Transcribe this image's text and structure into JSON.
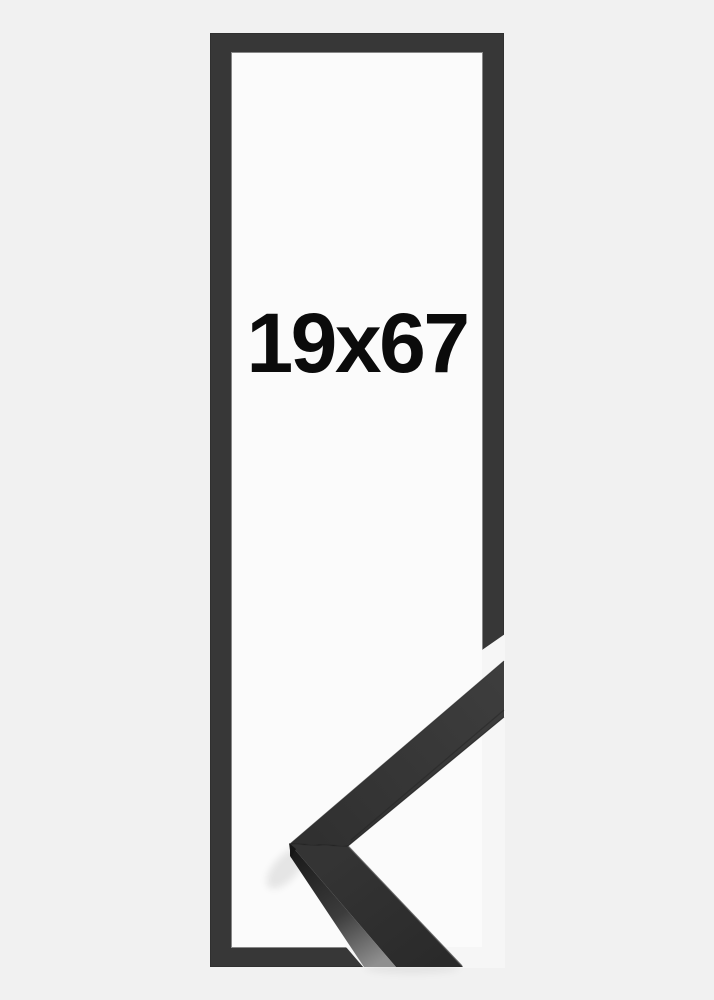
{
  "product": {
    "size_label": "19x67"
  },
  "images": {
    "corner_sample": "black-frame-mitred-corner-closeup"
  },
  "colors": {
    "background": "#f1f1f1",
    "aperture": "#fbfbfb",
    "frame": "#373737",
    "gap": "#f6f6f6",
    "label_text": "#0b0b0b"
  }
}
